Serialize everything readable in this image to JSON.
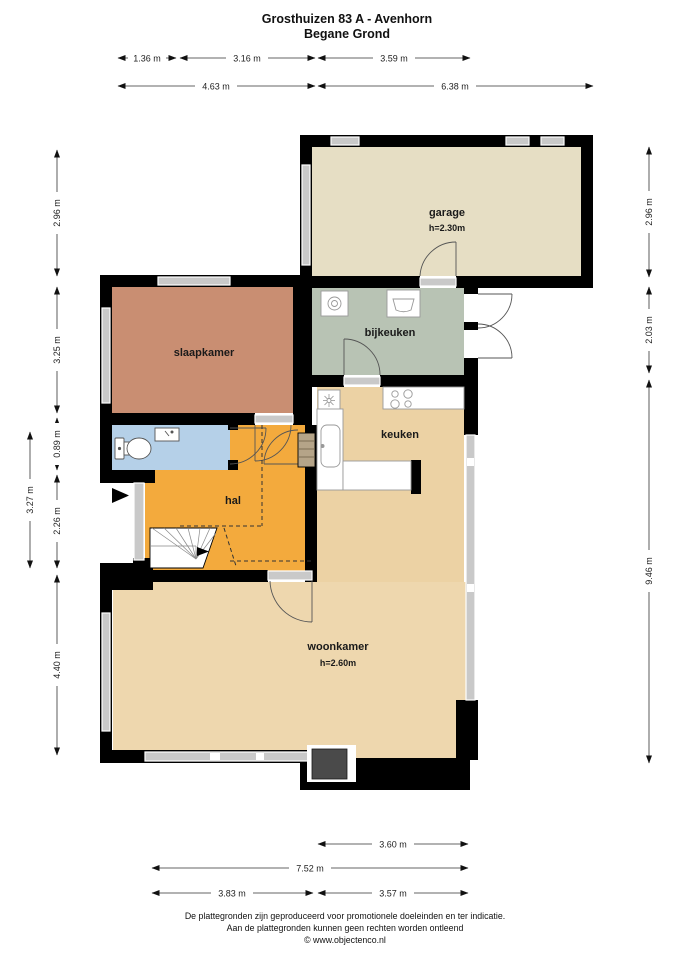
{
  "title": {
    "line1": "Grosthuizen 83 A - Avenhorn",
    "line2": "Begane Grond"
  },
  "rooms": {
    "garage": {
      "name": "garage",
      "height": "h=2.30m"
    },
    "bijkeuken": {
      "name": "bijkeuken"
    },
    "slaapkamer": {
      "name": "slaapkamer"
    },
    "keuken": {
      "name": "keuken"
    },
    "hal": {
      "name": "hal"
    },
    "woonkamer": {
      "name": "woonkamer",
      "height": "h=2.60m"
    }
  },
  "dims": {
    "top": [
      "1.36 m",
      "3.16 m",
      "3.59 m",
      "4.63 m",
      "6.38 m"
    ],
    "left": [
      "2.96 m",
      "3.25 m",
      "0.89 m",
      "2.26 m",
      "4.40 m",
      "3.27 m"
    ],
    "right": [
      "2.96 m",
      "2.03 m",
      "9.46 m"
    ],
    "bottom": [
      "3.60 m",
      "7.52 m",
      "3.83 m",
      "3.57 m"
    ]
  },
  "footer": {
    "line1": "De plattegronden zijn geproduceerd voor promotionele doeleinden en ter indicatie.",
    "line2": "Aan de plattegronden kunnen geen rechten worden ontleend",
    "line3": "© www.objectenco.nl"
  },
  "colors": {
    "garage": "#e6dec4",
    "bijkeuken": "#b8c3b4",
    "slaapkamer": "#c98e72",
    "keuken": "#ecd2a4",
    "woonkamer": "#eed7ae",
    "hal": "#f3aa3d",
    "toilet": "#b5d0e8",
    "wall": "#000000",
    "window": "#c9c9c9",
    "fireplace": "#4a4a4a",
    "cabinet": "#b5a488"
  },
  "icons": {
    "entrance-arrow": "solid right-pointing triangle",
    "stairs-arrow": "solid right-pointing triangle",
    "washing-machine": "square with drum circle",
    "laundry-sink": "square with tub",
    "ventilation": "square with fan asterisk",
    "stove": "four burner circles",
    "kitchen-sink": "rounded basin",
    "toilet": "cistern and bowl",
    "hand-basin": "small corner sink",
    "fireplace": "dark grey block"
  }
}
